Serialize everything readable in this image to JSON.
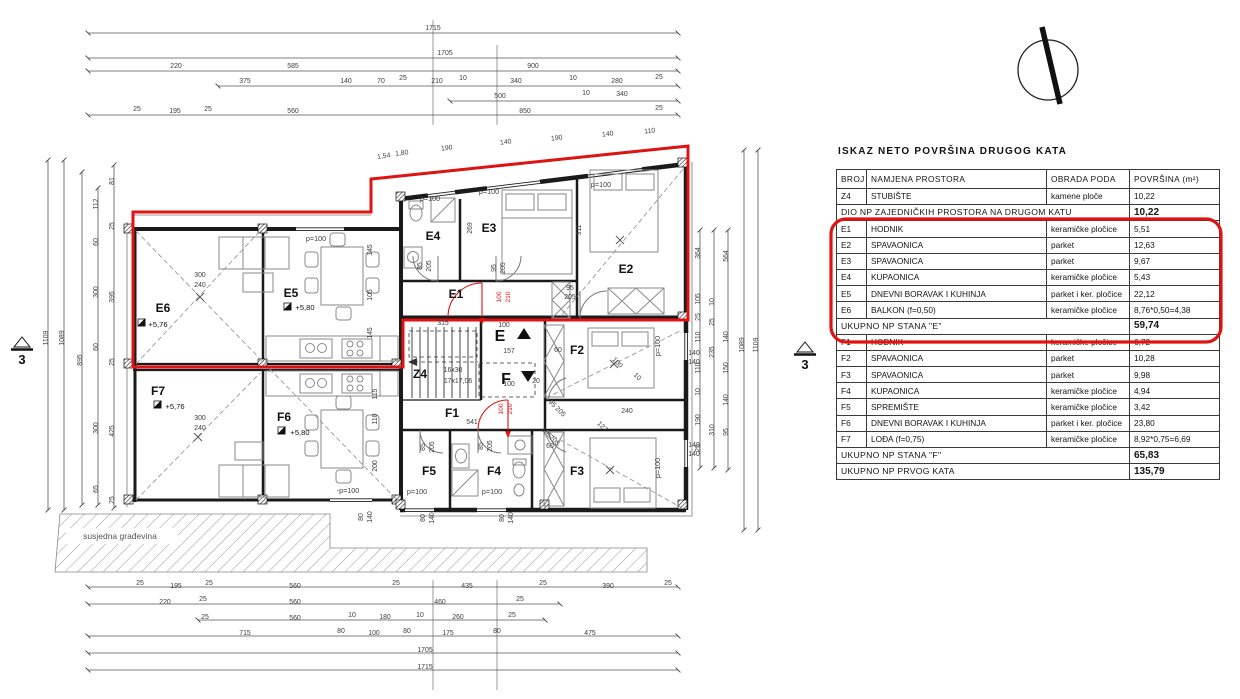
{
  "colors": {
    "highlight": "#e01313",
    "walls": "#1a1a1a",
    "dims": "#555555",
    "furniture": "#8a8a8a"
  },
  "table": {
    "title": "ISKAZ NETO POVRŠINA DRUGOG KATA",
    "headers": [
      "BROJ",
      "NAMJENA PROSTORA",
      "OBRADA PODA",
      "POVRŠINA (m²)"
    ],
    "rows": [
      {
        "broj": "Z4",
        "namjena": "STUBIŠTE",
        "obrada": "kamene ploče",
        "povrsina": "10,22"
      },
      {
        "namjena": "DIO NP ZAJEDNIČKIH PROSTORA NA DRUGOM KATU",
        "povrsina": "10,22",
        "merged": true,
        "total": true
      },
      {
        "broj": "E1",
        "namjena": "HODNIK",
        "obrada": "keramičke pločice",
        "povrsina": "5,51"
      },
      {
        "broj": "E2",
        "namjena": "SPAVAONICA",
        "obrada": "parket",
        "povrsina": "12,63"
      },
      {
        "broj": "E3",
        "namjena": "SPAVAONICA",
        "obrada": "parket",
        "povrsina": "9,67"
      },
      {
        "broj": "E4",
        "namjena": "KUPAONICA",
        "obrada": "keramičke pločice",
        "povrsina": "5,43"
      },
      {
        "broj": "E5",
        "namjena": "DNEVNI BORAVAK I KUHINJA",
        "obrada": "parket i ker. pločice",
        "povrsina": "22,12"
      },
      {
        "broj": "E6",
        "namjena": "BALKON (f=0,50)",
        "obrada": "keramičke pločice",
        "povrsina": "8,76*0,50=4,38"
      },
      {
        "namjena": "UKUPNO NP STANA \"E\"",
        "povrsina": "59,74",
        "merged": true,
        "total": true
      },
      {
        "broj": "F1",
        "namjena": "HODNIK",
        "obrada": "keramičke pločice",
        "povrsina": "6,72"
      },
      {
        "broj": "F2",
        "namjena": "SPAVAONICA",
        "obrada": "parket",
        "povrsina": "10,28"
      },
      {
        "broj": "F3",
        "namjena": "SPAVAONICA",
        "obrada": "parket",
        "povrsina": "9,98"
      },
      {
        "broj": "F4",
        "namjena": "KUPAONICA",
        "obrada": "keramičke pločice",
        "povrsina": "4,94"
      },
      {
        "broj": "F5",
        "namjena": "SPREMIŠTE",
        "obrada": "keramičke pločice",
        "povrsina": "3,42"
      },
      {
        "broj": "F6",
        "namjena": "DNEVNI BORAVAK I KUHINJA",
        "obrada": "parket i ker. pločice",
        "povrsina": "23,80"
      },
      {
        "broj": "F7",
        "namjena": "LOĐA (f=0,75)",
        "obrada": "keramičke pločice",
        "povrsina": "8,92*0,75=6,69"
      },
      {
        "namjena": "UKUPNO NP STANA \"F\"",
        "povrsina": "65,83",
        "merged": true,
        "total": true
      },
      {
        "namjena": "UKUPNO NP PRVOG KATA",
        "povrsina": "135,79",
        "merged": true,
        "total": true
      }
    ]
  },
  "plan": {
    "labels": [
      {
        "t": "E6",
        "x": 163,
        "y": 312,
        "c": "room"
      },
      {
        "t": "E5",
        "x": 291,
        "y": 297,
        "c": "room"
      },
      {
        "t": "E4",
        "x": 433,
        "y": 240,
        "c": "room"
      },
      {
        "t": "E3",
        "x": 489,
        "y": 232,
        "c": "room"
      },
      {
        "t": "E2",
        "x": 626,
        "y": 273,
        "c": "room"
      },
      {
        "t": "E1",
        "x": 456,
        "y": 298,
        "c": "room"
      },
      {
        "t": "Z4",
        "x": 420,
        "y": 378,
        "c": "room"
      },
      {
        "t": "F1",
        "x": 452,
        "y": 417,
        "c": "room"
      },
      {
        "t": "F2",
        "x": 577,
        "y": 354,
        "c": "room"
      },
      {
        "t": "F3",
        "x": 577,
        "y": 475,
        "c": "room"
      },
      {
        "t": "F4",
        "x": 494,
        "y": 475,
        "c": "room"
      },
      {
        "t": "F5",
        "x": 429,
        "y": 475,
        "c": "room"
      },
      {
        "t": "F6",
        "x": 284,
        "y": 421,
        "c": "room"
      },
      {
        "t": "F7",
        "x": 158,
        "y": 395,
        "c": "room"
      },
      {
        "t": "E",
        "x": 500,
        "y": 341,
        "c": "big"
      },
      {
        "t": "F",
        "x": 506,
        "y": 384,
        "c": "big"
      },
      {
        "t": "+5,76",
        "x": 158,
        "y": 327,
        "c": "e"
      },
      {
        "t": "+5,80",
        "x": 305,
        "y": 310,
        "c": "e"
      },
      {
        "t": "+5,76",
        "x": 175,
        "y": 409,
        "c": "e"
      },
      {
        "t": "+5,80",
        "x": 300,
        "y": 435,
        "c": "e"
      },
      {
        "t": "p=100",
        "x": 430,
        "y": 201,
        "c": "p"
      },
      {
        "t": "p=100",
        "x": 489,
        "y": 194,
        "c": "p"
      },
      {
        "t": "p=100",
        "x": 601,
        "y": 187,
        "c": "p"
      },
      {
        "t": "p=100",
        "x": 316,
        "y": 241,
        "c": "p"
      },
      {
        "t": "p=100",
        "x": 417,
        "y": 494,
        "c": "p"
      },
      {
        "t": "p=100",
        "x": 492,
        "y": 494,
        "c": "p"
      },
      {
        "t": "-p=100",
        "x": 348,
        "y": 493,
        "c": "p"
      },
      {
        "t": "p=100",
        "x": 660,
        "y": 346,
        "r": -90,
        "c": "p"
      },
      {
        "t": "p=100",
        "x": 660,
        "y": 468,
        "r": -90,
        "c": "p"
      },
      {
        "t": "susjedna građevina",
        "x": 120,
        "y": 539,
        "c": "n"
      },
      {
        "t": "3",
        "x": 22,
        "y": 364,
        "c": "s"
      },
      {
        "t": "3",
        "x": 805,
        "y": 369,
        "c": "s"
      },
      {
        "t": "16x30",
        "x": 453,
        "y": 372
      },
      {
        "t": "17x17,06",
        "x": 458,
        "y": 383
      },
      {
        "t": "1715",
        "x": 433,
        "y": 30
      },
      {
        "t": "1705",
        "x": 445,
        "y": 55
      },
      {
        "t": "220",
        "x": 176,
        "y": 68
      },
      {
        "t": "585",
        "x": 293,
        "y": 68
      },
      {
        "t": "900",
        "x": 533,
        "y": 68
      },
      {
        "t": "375",
        "x": 245,
        "y": 83
      },
      {
        "t": "140",
        "x": 346,
        "y": 83
      },
      {
        "t": "70",
        "x": 381,
        "y": 83
      },
      {
        "t": "25",
        "x": 403,
        "y": 80
      },
      {
        "t": "210",
        "x": 437,
        "y": 83
      },
      {
        "t": "10",
        "x": 463,
        "y": 80
      },
      {
        "t": "340",
        "x": 516,
        "y": 83
      },
      {
        "t": "10",
        "x": 573,
        "y": 80
      },
      {
        "t": "280",
        "x": 617,
        "y": 83
      },
      {
        "t": "25",
        "x": 659,
        "y": 79
      },
      {
        "t": "500",
        "x": 500,
        "y": 98
      },
      {
        "t": "10",
        "x": 586,
        "y": 95
      },
      {
        "t": "340",
        "x": 622,
        "y": 96
      },
      {
        "t": "25",
        "x": 137,
        "y": 111
      },
      {
        "t": "195",
        "x": 175,
        "y": 113
      },
      {
        "t": "25",
        "x": 208,
        "y": 111
      },
      {
        "t": "560",
        "x": 293,
        "y": 113
      },
      {
        "t": "850",
        "x": 525,
        "y": 113
      },
      {
        "t": "25",
        "x": 659,
        "y": 110
      },
      {
        "t": "25",
        "x": 140,
        "y": 585
      },
      {
        "t": "195",
        "x": 176,
        "y": 588
      },
      {
        "t": "25",
        "x": 209,
        "y": 585
      },
      {
        "t": "560",
        "x": 295,
        "y": 588
      },
      {
        "t": "25",
        "x": 396,
        "y": 585
      },
      {
        "t": "435",
        "x": 467,
        "y": 588
      },
      {
        "t": "25",
        "x": 543,
        "y": 585
      },
      {
        "t": "390",
        "x": 608,
        "y": 588
      },
      {
        "t": "25",
        "x": 668,
        "y": 585
      },
      {
        "t": "220",
        "x": 165,
        "y": 604
      },
      {
        "t": "25",
        "x": 203,
        "y": 601
      },
      {
        "t": "560",
        "x": 295,
        "y": 604
      },
      {
        "t": "460",
        "x": 440,
        "y": 604
      },
      {
        "t": "25",
        "x": 520,
        "y": 601
      },
      {
        "t": "25",
        "x": 205,
        "y": 619
      },
      {
        "t": "560",
        "x": 295,
        "y": 620
      },
      {
        "t": "10",
        "x": 352,
        "y": 617
      },
      {
        "t": "180",
        "x": 385,
        "y": 619
      },
      {
        "t": "10",
        "x": 420,
        "y": 617
      },
      {
        "t": "260",
        "x": 458,
        "y": 619
      },
      {
        "t": "25",
        "x": 512,
        "y": 617
      },
      {
        "t": "715",
        "x": 245,
        "y": 635
      },
      {
        "t": "80",
        "x": 341,
        "y": 633
      },
      {
        "t": "100",
        "x": 374,
        "y": 635
      },
      {
        "t": "80",
        "x": 407,
        "y": 633
      },
      {
        "t": "175",
        "x": 448,
        "y": 635
      },
      {
        "t": "80",
        "x": 497,
        "y": 633
      },
      {
        "t": "475",
        "x": 590,
        "y": 635
      },
      {
        "t": "1705",
        "x": 425,
        "y": 652
      },
      {
        "t": "1715",
        "x": 425,
        "y": 669
      },
      {
        "t": "1109",
        "x": 48,
        "y": 338,
        "r": -90
      },
      {
        "t": "1089",
        "x": 64,
        "y": 338,
        "r": -90
      },
      {
        "t": "895",
        "x": 82,
        "y": 360,
        "r": -90
      },
      {
        "t": "112",
        "x": 98,
        "y": 204,
        "r": -90
      },
      {
        "t": "60",
        "x": 98,
        "y": 242,
        "r": -90
      },
      {
        "t": "300",
        "x": 98,
        "y": 292,
        "r": -90
      },
      {
        "t": "60",
        "x": 98,
        "y": 347,
        "r": -90
      },
      {
        "t": "300",
        "x": 98,
        "y": 428,
        "r": -90
      },
      {
        "t": "65",
        "x": 98,
        "y": 489,
        "r": -90
      },
      {
        "t": "81",
        "x": 114,
        "y": 181,
        "r": -90
      },
      {
        "t": "25",
        "x": 114,
        "y": 226,
        "r": -90
      },
      {
        "t": "395",
        "x": 114,
        "y": 297,
        "r": -90
      },
      {
        "t": "25",
        "x": 114,
        "y": 362,
        "r": -90
      },
      {
        "t": "425",
        "x": 114,
        "y": 431,
        "r": -90
      },
      {
        "t": "25",
        "x": 114,
        "y": 500,
        "r": -90
      },
      {
        "t": "364",
        "x": 700,
        "y": 253,
        "r": -90
      },
      {
        "t": "105",
        "x": 700,
        "y": 299,
        "r": -90
      },
      {
        "t": "25",
        "x": 700,
        "y": 317,
        "r": -90
      },
      {
        "t": "110",
        "x": 700,
        "y": 337,
        "r": -90
      },
      {
        "t": "110",
        "x": 700,
        "y": 368,
        "r": -90
      },
      {
        "t": "10",
        "x": 700,
        "y": 392,
        "r": -90
      },
      {
        "t": "190",
        "x": 700,
        "y": 420,
        "r": -90
      },
      {
        "t": "25",
        "x": 700,
        "y": 448,
        "r": -90
      },
      {
        "t": "10",
        "x": 714,
        "y": 302,
        "r": -90
      },
      {
        "t": "25",
        "x": 714,
        "y": 322,
        "r": -90
      },
      {
        "t": "235",
        "x": 714,
        "y": 352,
        "r": -90
      },
      {
        "t": "310",
        "x": 714,
        "y": 430,
        "r": -90
      },
      {
        "t": "564",
        "x": 728,
        "y": 256,
        "r": -90
      },
      {
        "t": "140",
        "x": 728,
        "y": 337,
        "r": -90
      },
      {
        "t": "150",
        "x": 728,
        "y": 368,
        "r": -90
      },
      {
        "t": "140",
        "x": 728,
        "y": 400,
        "r": -90
      },
      {
        "t": "95",
        "x": 728,
        "y": 432,
        "r": -90
      },
      {
        "t": "1089",
        "x": 744,
        "y": 345,
        "r": -90
      },
      {
        "t": "1109",
        "x": 758,
        "y": 345,
        "r": -90
      },
      {
        "t": "140",
        "x": 694,
        "y": 355
      },
      {
        "t": "140",
        "x": 694,
        "y": 364
      },
      {
        "t": "140",
        "x": 694,
        "y": 447
      },
      {
        "t": "140",
        "x": 694,
        "y": 456
      },
      {
        "t": "1,54",
        "x": 384,
        "y": 158,
        "r": -7
      },
      {
        "t": "1,80",
        "x": 402,
        "y": 155,
        "r": -7
      },
      {
        "t": "190",
        "x": 447,
        "y": 150,
        "r": -7
      },
      {
        "t": "140",
        "x": 506,
        "y": 144,
        "r": -7
      },
      {
        "t": "190",
        "x": 557,
        "y": 140,
        "r": -7
      },
      {
        "t": "140",
        "x": 608,
        "y": 136,
        "r": -7
      },
      {
        "t": "110",
        "x": 650,
        "y": 133,
        "r": -7
      },
      {
        "t": "315",
        "x": 443,
        "y": 325
      },
      {
        "t": "100",
        "x": 504,
        "y": 327
      },
      {
        "t": "157",
        "x": 509,
        "y": 353
      },
      {
        "t": "100",
        "x": 509,
        "y": 386
      },
      {
        "t": "20",
        "x": 536,
        "y": 383
      },
      {
        "t": "541",
        "x": 472,
        "y": 424
      },
      {
        "t": "95",
        "x": 570,
        "y": 290
      },
      {
        "t": "205",
        "x": 570,
        "y": 299
      },
      {
        "t": "240",
        "x": 627,
        "y": 413
      },
      {
        "t": "60",
        "x": 550,
        "y": 448
      },
      {
        "t": "60",
        "x": 558,
        "y": 352
      },
      {
        "t": "300",
        "x": 200,
        "y": 277
      },
      {
        "t": "240",
        "x": 200,
        "y": 287
      },
      {
        "t": "300",
        "x": 200,
        "y": 420
      },
      {
        "t": "240",
        "x": 200,
        "y": 430
      },
      {
        "t": "85",
        "x": 422,
        "y": 266,
        "r": -90
      },
      {
        "t": "205",
        "x": 431,
        "y": 266,
        "r": -90
      },
      {
        "t": "95",
        "x": 496,
        "y": 268,
        "r": -90
      },
      {
        "t": "205",
        "x": 505,
        "y": 268,
        "r": -90
      },
      {
        "t": "269",
        "x": 472,
        "y": 228,
        "r": -90
      },
      {
        "t": "311",
        "x": 581,
        "y": 230,
        "r": -90
      },
      {
        "t": "85",
        "x": 425,
        "y": 447,
        "r": -90
      },
      {
        "t": "205",
        "x": 434,
        "y": 447,
        "r": -90
      },
      {
        "t": "85",
        "x": 483,
        "y": 446,
        "r": -90
      },
      {
        "t": "205",
        "x": 492,
        "y": 446,
        "r": -90
      },
      {
        "t": "145",
        "x": 372,
        "y": 250,
        "r": -90
      },
      {
        "t": "105",
        "x": 372,
        "y": 295,
        "r": -90
      },
      {
        "t": "145",
        "x": 372,
        "y": 333,
        "r": -90
      },
      {
        "t": "115",
        "x": 377,
        "y": 394,
        "r": -90
      },
      {
        "t": "110",
        "x": 377,
        "y": 419,
        "r": -90
      },
      {
        "t": "200",
        "x": 377,
        "y": 466,
        "r": -90
      },
      {
        "t": "80",
        "x": 425,
        "y": 518,
        "r": -90
      },
      {
        "t": "140",
        "x": 434,
        "y": 518,
        "r": -90
      },
      {
        "t": "80",
        "x": 504,
        "y": 518,
        "r": -90
      },
      {
        "t": "140",
        "x": 513,
        "y": 518,
        "r": -90
      },
      {
        "t": "80",
        "x": 363,
        "y": 517,
        "r": -90
      },
      {
        "t": "140",
        "x": 372,
        "y": 517,
        "r": -90
      },
      {
        "t": "100",
        "x": 616,
        "y": 364,
        "r": 45
      },
      {
        "t": "10",
        "x": 636,
        "y": 378,
        "r": 45
      },
      {
        "t": "95",
        "x": 551,
        "y": 405,
        "r": 45
      },
      {
        "t": "205",
        "x": 559,
        "y": 413,
        "r": 45
      },
      {
        "t": "105",
        "x": 545,
        "y": 434,
        "r": 45
      },
      {
        "t": "205",
        "x": 553,
        "y": 442,
        "r": 45
      },
      {
        "t": "127",
        "x": 601,
        "y": 428,
        "r": 45
      },
      {
        "t": "100",
        "x": 501,
        "y": 297,
        "r": -90,
        "c": "red"
      },
      {
        "t": "210",
        "x": 510,
        "y": 297,
        "r": -90,
        "c": "red"
      },
      {
        "t": "100",
        "x": 503,
        "y": 409,
        "r": -90,
        "c": "red"
      },
      {
        "t": "210",
        "x": 512,
        "y": 409,
        "r": -90,
        "c": "red"
      }
    ]
  }
}
